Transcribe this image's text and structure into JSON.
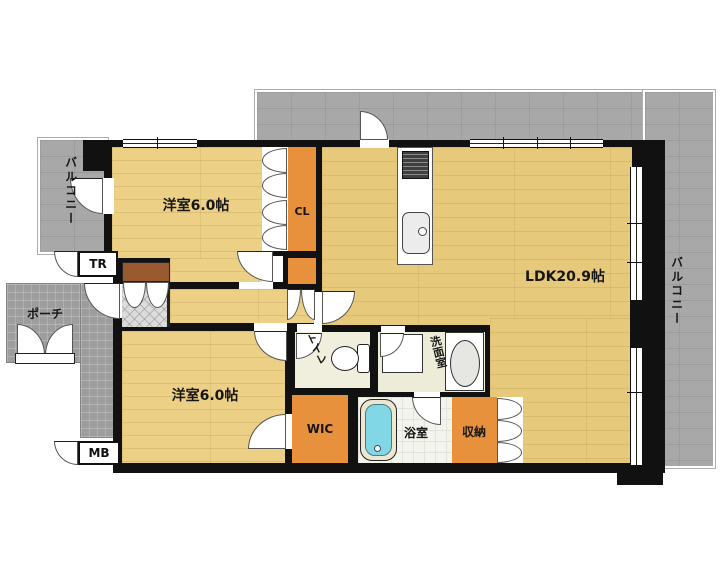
{
  "plan": {
    "title": "apartment-floorplan",
    "rooms": [
      {
        "id": "bedroom-top",
        "label": "洋室6.0帖"
      },
      {
        "id": "closet-cl",
        "label": "CL"
      },
      {
        "id": "ldk",
        "label": "LDK20.9帖"
      },
      {
        "id": "bedroom-bottom",
        "label": "洋室6.0帖"
      },
      {
        "id": "toilet",
        "label": "トイレ"
      },
      {
        "id": "washroom",
        "label": "洗面室"
      },
      {
        "id": "wic",
        "label": "WIC"
      },
      {
        "id": "bathroom",
        "label": "浴室"
      },
      {
        "id": "storage",
        "label": "収納"
      }
    ],
    "outdoor": [
      {
        "id": "balcony-left",
        "label": "バルコニー"
      },
      {
        "id": "balcony-right",
        "label": "バルコニー"
      },
      {
        "id": "porch",
        "label": "ポーチ"
      }
    ],
    "boxes": [
      {
        "id": "trunk-room",
        "label": "TR"
      },
      {
        "id": "meter-box",
        "label": "MB"
      }
    ],
    "fixtures": [
      "kitchen-stove",
      "kitchen-sink",
      "bathtub",
      "toilet-bowl",
      "wash-basin",
      "washing-machine-pan",
      "shoe-cabinet"
    ],
    "colors": {
      "wall": "#111111",
      "wood_floor_ldk": "#e7c97b",
      "wood_floor_rooms": "#ecd086",
      "closet_orange": "#e8913c",
      "balcony_gray": "#a8a8a8",
      "porch_gray": "#9d9d9d",
      "bathtub_cyan": "#82d7e6",
      "toilet_floor": "#f0eedc"
    }
  }
}
